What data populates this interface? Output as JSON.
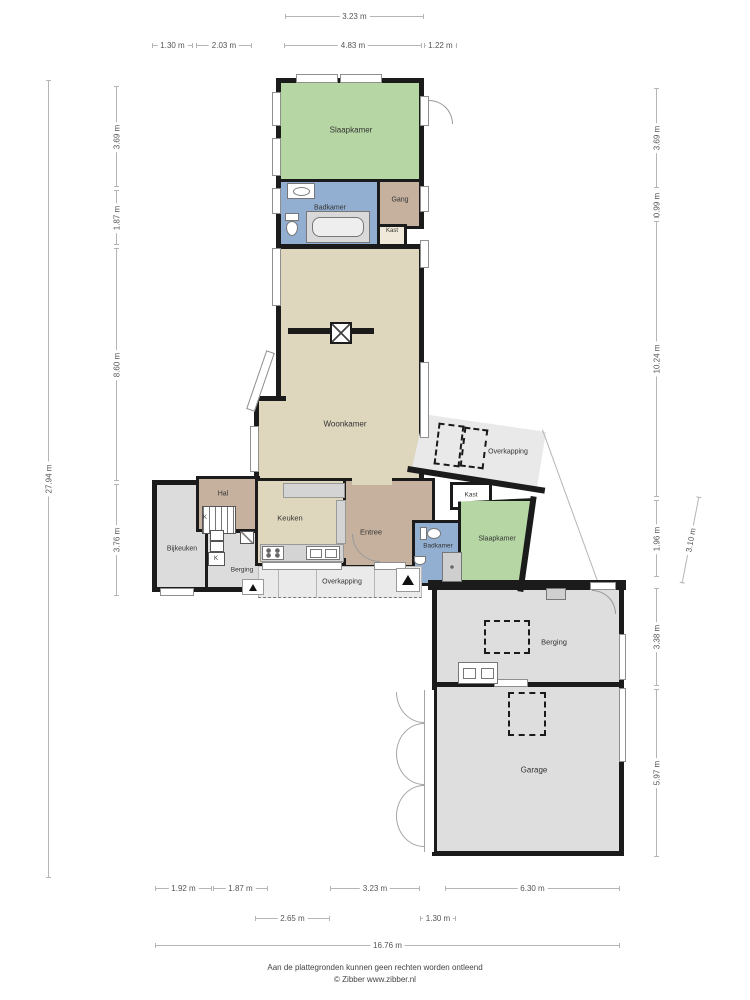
{
  "footer": {
    "line1": "Aan de plattegronden kunnen geen rechten worden ontleend",
    "line2": "© Zibber www.zibber.nl"
  },
  "colors": {
    "wall": "#1b1b1b",
    "bedroom_green": "#b6d7a4",
    "bathroom_blue": "#92afd2",
    "hall_tan": "#c6b19e",
    "living_beige": "#ded6bd",
    "utility_gray": "#dcdcdc",
    "canopy_gray": "#e9e9e9"
  },
  "rooms": {
    "slaapkamer_top": "Slaapkamer",
    "badkamer_top": "Badkamer",
    "gang": "Gang",
    "kast_top": "Kast",
    "woonkamer": "Woonkamer",
    "hal": "Hal",
    "keuken": "Keuken",
    "bijkeuken": "Bijkeuken",
    "berging_small": "Berging",
    "entree": "Entree",
    "badkamer_bottom": "Badkamer",
    "kast_bottom": "Kast",
    "slaapkamer_bottom": "Slaapkamer",
    "overkapping_right": "Overkapping",
    "overkapping_bottom": "Overkapping",
    "berging_garage": "Berging",
    "garage": "Garage",
    "kast_k1": "K",
    "kast_k2": "K"
  },
  "dims": {
    "top_1": "3.23 m",
    "top_2": "1.30 m",
    "top_3": "2.03 m",
    "top_4": "4.83 m",
    "top_5": "1.22 m",
    "left_total": "27.94 m",
    "left_1": "3.69 m",
    "left_2": "1.87 m",
    "left_3": "8.60 m",
    "left_4": "3.76 m",
    "right_1": "3.69 m",
    "right_2": "0.99 m",
    "right_3": "10.24 m",
    "right_4": "1.96 m",
    "right_5": "3.10 m",
    "right_6": "3.38 m",
    "right_7": "5.97 m",
    "bottom_1": "1.92 m",
    "bottom_2": "1.87 m",
    "bottom_3": "3.23 m",
    "bottom_4": "6.30 m",
    "bottom_5": "2.65 m",
    "bottom_6": "1.30 m",
    "bottom_total": "16.76 m"
  }
}
